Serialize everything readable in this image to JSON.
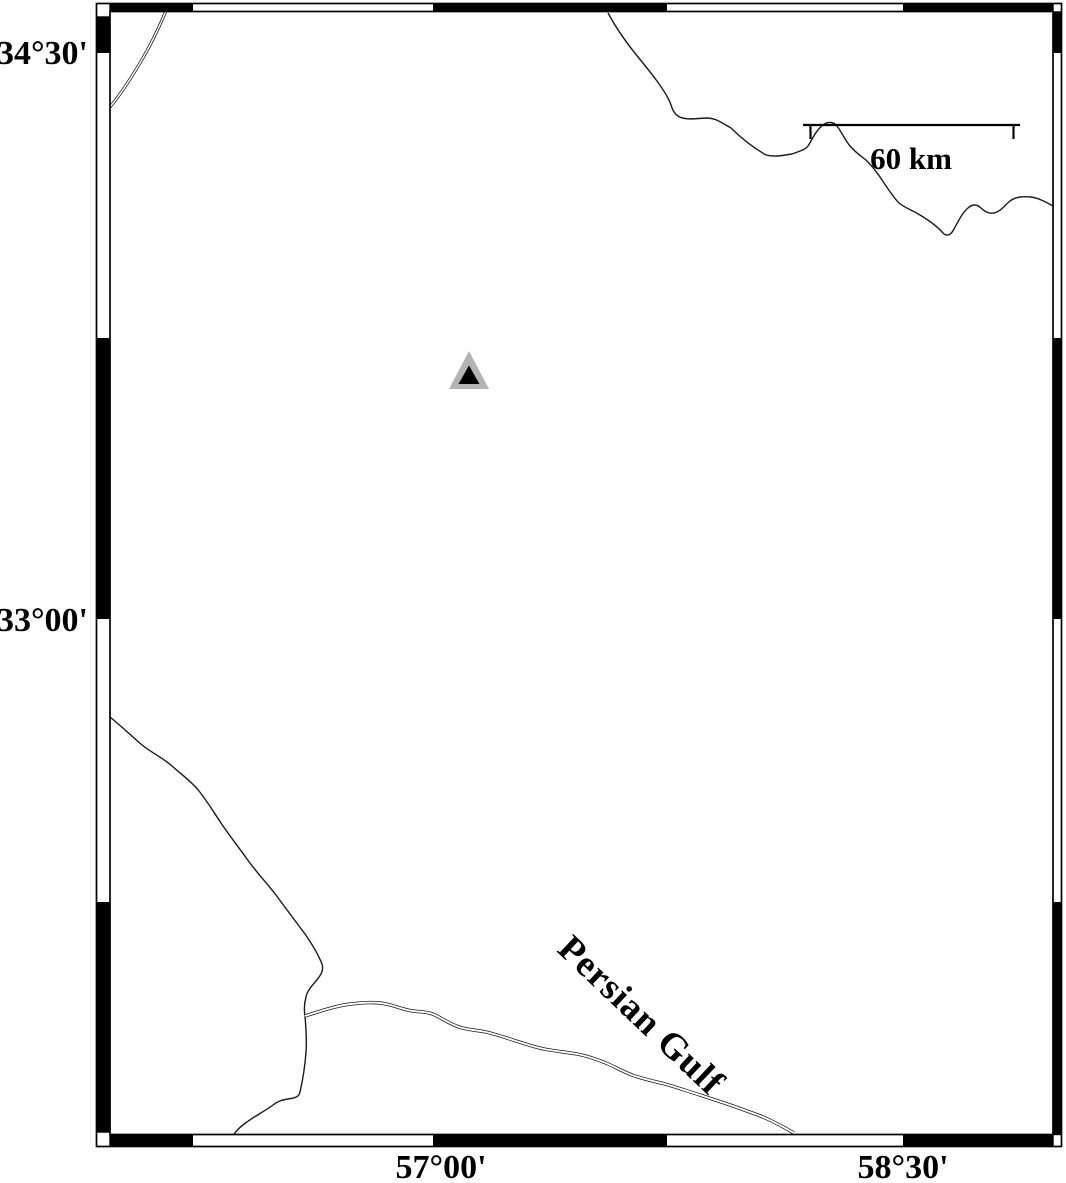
{
  "map": {
    "description": "black-and-white geographic map with fancy alternating border frame",
    "colors": {
      "background": "#ffffff",
      "frame": "#000000",
      "coastline": "#1a1a1a",
      "marker_fill": "#000000",
      "marker_outline": "#b4b4b4"
    },
    "left_axis": {
      "labels": [
        {
          "text": "34°30'"
        },
        {
          "text": "33°00'"
        }
      ]
    },
    "bottom_axis": {
      "labels": [
        {
          "text": "57°00'"
        },
        {
          "text": "58°30'"
        }
      ]
    },
    "scale_bar": {
      "label": "60 km"
    },
    "annotations": {
      "water_body": "Persian Gulf"
    },
    "marker": {
      "shape": "triangle"
    }
  }
}
